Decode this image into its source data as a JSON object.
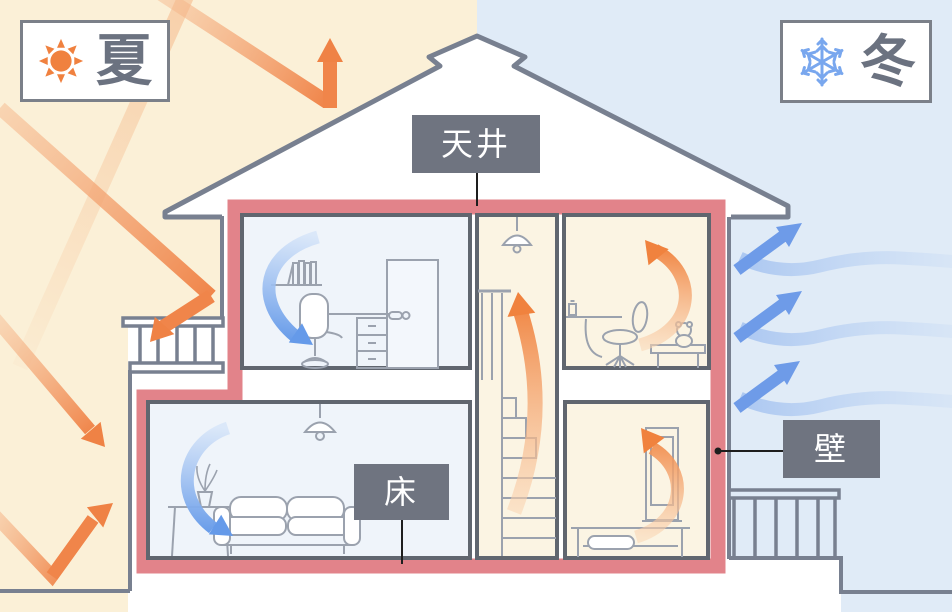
{
  "legend": {
    "summer": {
      "label": "夏",
      "icon": "sun-icon"
    },
    "winter": {
      "label": "冬",
      "icon": "snowflake-icon"
    }
  },
  "callouts": {
    "ceiling": "天井",
    "floor": "床",
    "wall": "壁"
  },
  "colors": {
    "summer_bg": "#FBF0D7",
    "winter_bg": "#E0EBF7",
    "insulation_red": "#E2838A",
    "heat_orange": "#F0854A",
    "cold_blue": "#6E9BE8",
    "outline_gray": "#788090",
    "label_bg": "#6F7480"
  }
}
